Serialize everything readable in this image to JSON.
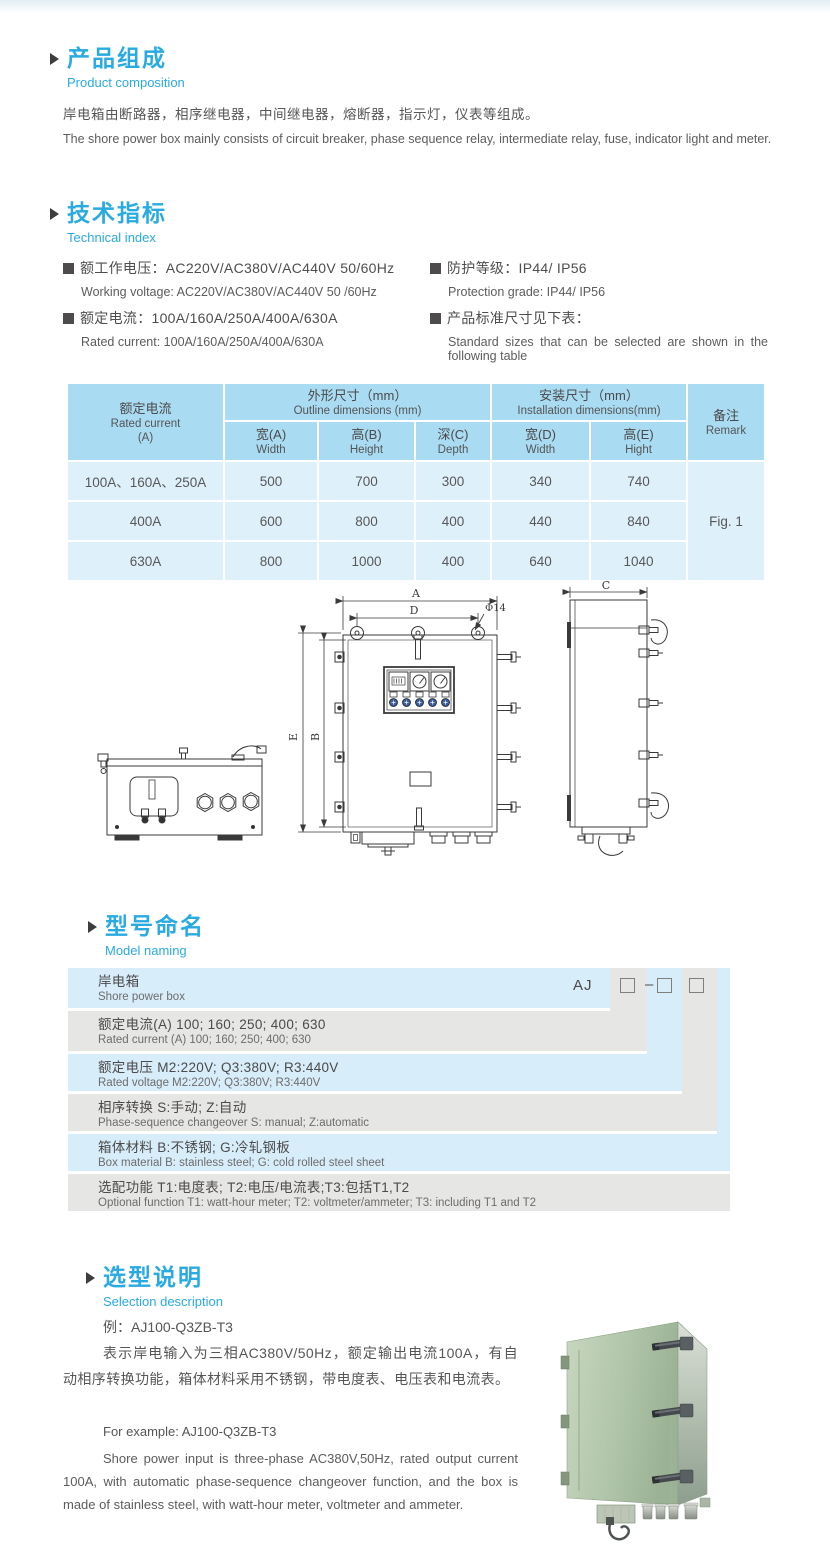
{
  "colors": {
    "accent": "#29abe2",
    "body_text": "#595757",
    "table_header_bg": "#a9dbf2",
    "table_cell_bg": "#def1fb",
    "naming_blue": "#d7edf9",
    "naming_gray": "#e6e6e4",
    "indicator_blue": "#3c5d9e",
    "box_green": "#aec3a7"
  },
  "product_composition": {
    "title_zh": "产品组成",
    "title_en": "Product  composition",
    "body_zh": "岸电箱由断路器，相序继电器，中间继电器，熔断器，指示灯，仪表等组成。",
    "body_en": "The shore power box mainly consists of circuit breaker, phase sequence relay, intermediate relay, fuse, indicator light and meter."
  },
  "technical_index": {
    "title_zh": "技术指标",
    "title_en": "Technical index",
    "items": [
      {
        "zh": "额工作电压：AC220V/AC380V/AC440V  50/60Hz",
        "en": "Working voltage: AC220V/AC380V/AC440V 50 /60Hz"
      },
      {
        "zh": "额定电流：100A/160A/250A/400A/630A",
        "en": "Rated current: 100A/160A/250A/400A/630A"
      },
      {
        "zh": "防护等级：IP44/ IP56",
        "en": "Protection grade: IP44/ IP56"
      },
      {
        "zh": "产品标准尺寸见下表：",
        "en": "Standard sizes that can be selected are shown in the following table"
      }
    ]
  },
  "dimension_table": {
    "header": {
      "current": [
        "额定电流",
        "Rated current",
        "(A)"
      ],
      "outline": [
        "外形尺寸（mm）",
        "Outline dimensions (mm)"
      ],
      "install": [
        "安装尺寸（mm）",
        "Installation dimensions(mm)"
      ],
      "remark": [
        "备注",
        "Remark"
      ],
      "sub": [
        [
          "宽(A)",
          "Width"
        ],
        [
          "高(B)",
          "Height"
        ],
        [
          "深(C)",
          "Depth"
        ],
        [
          "宽(D)",
          "Width"
        ],
        [
          "高(E)",
          "Hight"
        ]
      ]
    },
    "rows": [
      {
        "current": "100A、160A、250A",
        "w": "500",
        "h": "700",
        "d": "300",
        "iw": "340",
        "ih": "740"
      },
      {
        "current": "400A",
        "w": "600",
        "h": "800",
        "d": "400",
        "iw": "440",
        "ih": "840"
      },
      {
        "current": "630A",
        "w": "800",
        "h": "1000",
        "d": "400",
        "iw": "640",
        "ih": "1040"
      }
    ],
    "remark_value": "Fig. 1"
  },
  "figure": {
    "labels": {
      "A": "A",
      "D": "D",
      "phi": "Φ14",
      "E": "E",
      "B": "B",
      "C": "C"
    }
  },
  "model_naming": {
    "title_zh": "型号命名",
    "title_en": "Model naming",
    "code": {
      "prefix": "AJ",
      "dash": "–"
    },
    "rows": [
      {
        "zh": "岸电箱",
        "en": "Shore power box"
      },
      {
        "zh": "额定电流(A)  100; 160; 250; 400; 630",
        "en": "Rated current (A) 100; 160; 250; 400; 630"
      },
      {
        "zh": "额定电压   M2:220V;  Q3:380V;  R3:440V",
        "en": "Rated voltage  M2:220V;  Q3:380V;  R3:440V"
      },
      {
        "zh": "相序转换  S:手动; Z:自动",
        "en": "Phase-sequence changeover  S: manual;  Z:automatic"
      },
      {
        "zh": "箱体材料     B:不锈钢;  G:冷轧钢板",
        "en": "Box material   B: stainless steel; G: cold rolled steel sheet"
      },
      {
        "zh": "选配功能      T1:电度表;  T2:电压/电流表;T3:包括T1,T2",
        "en": "Optional function  T1: watt-hour meter; T2: voltmeter/ammeter; T3: including T1 and T2"
      }
    ]
  },
  "selection": {
    "title_zh": "选型说明",
    "title_en": "Selection description",
    "example_zh": "例：AJ100-Q3ZB-T3",
    "body_zh": "表示岸电输入为三相AC380V/50Hz，额定输出电流100A，有自动相序转换功能，箱体材料采用不锈钢，带电度表、电压表和电流表。",
    "example_en": "For example: AJ100-Q3ZB-T3",
    "body_en": "Shore power input is three-phase AC380V,50Hz, rated output current 100A, with automatic phase-sequence changeover function, and the box is made of stainless steel, with watt-hour meter, voltmeter and ammeter."
  }
}
